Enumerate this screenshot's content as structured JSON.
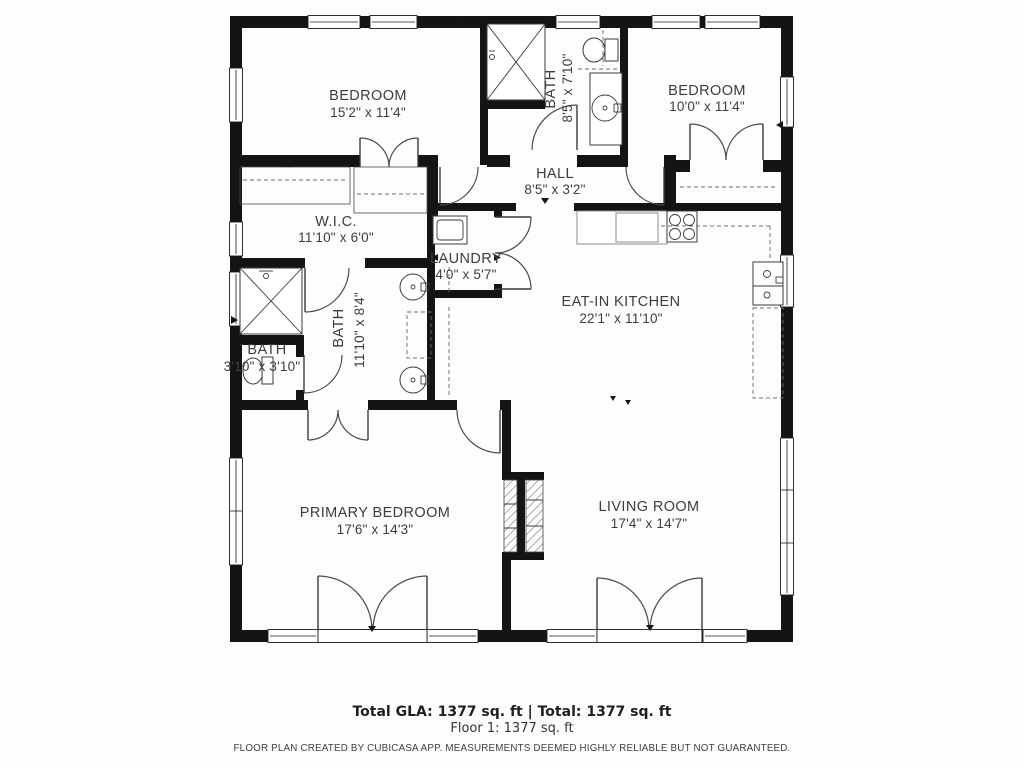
{
  "rooms": {
    "bedroom1": {
      "name": "BEDROOM",
      "dims": "15'2\" x 11'4\""
    },
    "bath1": {
      "name": "BATH",
      "dims": "8'5\" x 7'10\""
    },
    "bedroom2": {
      "name": "BEDROOM",
      "dims": "10'0\" x 11'4\""
    },
    "hall": {
      "name": "HALL",
      "dims": "8'5\" x 3'2\""
    },
    "wic": {
      "name": "W.I.C.",
      "dims": "11'10\" x 6'0\""
    },
    "laundry": {
      "name": "LAUNDRY",
      "dims": "4'0\" x 5'7\""
    },
    "kitchen": {
      "name": "EAT-IN KITCHEN",
      "dims": "22'1\" x 11'10\""
    },
    "bath2": {
      "name": "BATH",
      "dims": "11'10\" x 8'4\""
    },
    "bath3": {
      "name": "BATH",
      "dims": "3'10\" x 3'10\""
    },
    "primary": {
      "name": "PRIMARY BEDROOM",
      "dims": "17'6\" x 14'3\""
    },
    "living": {
      "name": "LIVING ROOM",
      "dims": "17'4\" x 14'7\""
    }
  },
  "footer": {
    "total": "Total GLA: 1377 sq. ft | Total: 1377 sq. ft",
    "floor": "Floor 1: 1377 sq. ft",
    "disclaimer": "FLOOR PLAN CREATED BY CUBICASA APP. MEASUREMENTS DEEMED HIGHLY RELIABLE BUT NOT GUARANTEED."
  },
  "colors": {
    "wall": "#141414",
    "label_text": "#3d3d3d",
    "door_arc": "#4a4a4a"
  }
}
